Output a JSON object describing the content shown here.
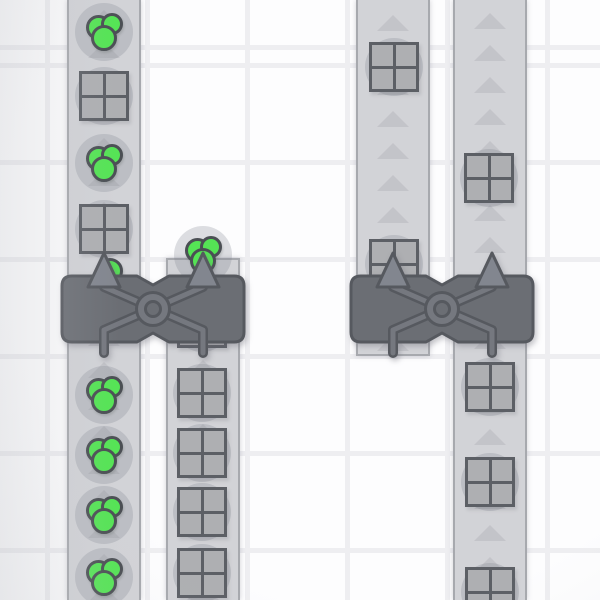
{
  "meta": {
    "app": "factory-game-viewport",
    "view": "top-down conveyor network with two balancer machines"
  },
  "scene": {
    "canvas": {
      "width": 600,
      "height": 600
    },
    "colors": {
      "tile": "#fdfdfe",
      "grid_line": "#eeeef1",
      "belt": "#d2d3d7",
      "belt_edge": "#a7a9ae",
      "chevron": "#c3c4c9",
      "item_shadow": "rgba(125,128,138,0.25)",
      "square_fill": "#aeafb2",
      "square_border": "#5c5f65",
      "green_fill": "#55e455",
      "green_border": "#4b4f54",
      "machine_body": "#6b6e74",
      "machine_outline": "#56595f",
      "machine_arm": "#75787f",
      "machine_arrow": "#82868f"
    },
    "chevron": {
      "width": 32,
      "height": 16,
      "pitch": 32
    },
    "belts": [
      {
        "id": "belt-a",
        "x": 67,
        "y": 0,
        "width": 74,
        "height": 600,
        "cap_top": false,
        "cap_bottom": false,
        "chevron_phase": 10
      },
      {
        "id": "belt-b",
        "x": 166,
        "y": 258,
        "width": 74,
        "height": 342,
        "cap_top": true,
        "cap_bottom": false,
        "chevron_phase": 6
      },
      {
        "id": "belt-c",
        "x": 356,
        "y": 0,
        "width": 74,
        "height": 356,
        "cap_top": false,
        "cap_bottom": true,
        "chevron_phase": 15
      },
      {
        "id": "belt-d",
        "x": 453,
        "y": 0,
        "width": 74,
        "height": 600,
        "cap_top": false,
        "cap_bottom": false,
        "chevron_phase": 13
      }
    ],
    "items": [
      {
        "type": "green",
        "x": 104,
        "y": 32
      },
      {
        "type": "square",
        "x": 104,
        "y": 96
      },
      {
        "type": "green",
        "x": 104,
        "y": 163
      },
      {
        "type": "square",
        "x": 104,
        "y": 229
      },
      {
        "type": "green_peek",
        "x": 110,
        "y": 271
      },
      {
        "type": "green",
        "x": 203,
        "y": 255
      },
      {
        "type": "square",
        "x": 394,
        "y": 67
      },
      {
        "type": "square",
        "x": 394,
        "y": 264
      },
      {
        "type": "square",
        "x": 489,
        "y": 178
      },
      {
        "type": "square",
        "x": 202,
        "y": 323
      },
      {
        "type": "square",
        "x": 202,
        "y": 393
      },
      {
        "type": "square",
        "x": 202,
        "y": 453
      },
      {
        "type": "square",
        "x": 202,
        "y": 512
      },
      {
        "type": "square",
        "x": 202,
        "y": 573
      },
      {
        "type": "green",
        "x": 104,
        "y": 395
      },
      {
        "type": "green",
        "x": 104,
        "y": 455
      },
      {
        "type": "green",
        "x": 104,
        "y": 515
      },
      {
        "type": "green",
        "x": 104,
        "y": 577
      },
      {
        "type": "square",
        "x": 490,
        "y": 387
      },
      {
        "type": "square",
        "x": 490,
        "y": 482
      },
      {
        "type": "square",
        "x": 490,
        "y": 592
      }
    ],
    "machines": [
      {
        "id": "balancer-left",
        "x": 58,
        "y": 238
      },
      {
        "id": "balancer-right",
        "x": 347,
        "y": 238
      }
    ],
    "machine_geometry": {
      "svg_w": 190,
      "svg_h": 124,
      "body": {
        "left": 4,
        "top": 38,
        "right": 186,
        "bottom": 104,
        "radius": 10,
        "notch_half": 16,
        "notch_depth": 9
      },
      "lanes": [
        46,
        145
      ],
      "arrow": {
        "half_w": 16,
        "apex_y": 15,
        "base_y": 49
      },
      "arm": {
        "bend_y": 92,
        "end_y": 115,
        "top_y": 49
      },
      "ring": {
        "cy": 71,
        "outer_r": 16.5,
        "inner_r": 7.5
      }
    },
    "green_cluster": {
      "circles": [
        {
          "dx": -6,
          "dy": -5,
          "d": 25
        },
        {
          "dx": 8,
          "dy": -8,
          "d": 22
        },
        {
          "dx": 0,
          "dy": 6,
          "d": 26
        }
      ],
      "peek_d": 26
    }
  }
}
